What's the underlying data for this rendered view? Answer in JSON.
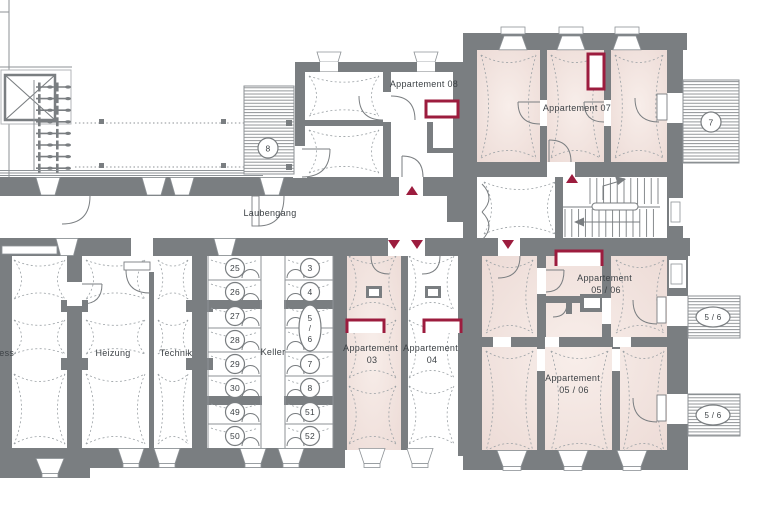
{
  "floorplan": {
    "corridor": {
      "label": "Laubengang"
    },
    "rooms": {
      "fitness": {
        "label": "ness"
      },
      "heizung": {
        "label": "Heizung"
      },
      "technik": {
        "label": "Technik"
      },
      "keller": {
        "label": "Keller"
      },
      "apartment_03": {
        "line1": "Appartement",
        "line2": "03"
      },
      "apartment_04": {
        "line1": "Appartement",
        "line2": "04"
      },
      "apartment_05_06_upper": {
        "line1": "Appartement",
        "line2": "05 / 06"
      },
      "apartment_05_06_lower": {
        "line1": "Appartement",
        "line2": "05 / 06"
      },
      "apartment_07": {
        "label": "Appartement 07"
      },
      "apartment_08": {
        "label": "Appartement 08"
      }
    },
    "terraces": {
      "t7": {
        "label": "7"
      },
      "t8": {
        "label": "8"
      },
      "t56_upper": {
        "label": "5 / 6"
      },
      "t56_lower": {
        "label": "5 / 6"
      }
    },
    "keller_units": {
      "left": [
        "25",
        "26",
        "27",
        "28",
        "29",
        "30",
        "49",
        "50"
      ],
      "right": [
        "3",
        "4",
        "7",
        "8",
        "51",
        "52"
      ],
      "oval": {
        "top": "5",
        "mid": "/",
        "bottom": "6"
      }
    },
    "colors": {
      "wall": "#7a7e81",
      "apartment_fill": "#f2e3df",
      "accent": "#9c1c3e",
      "line": "#8d9296",
      "text": "#3d4246"
    }
  }
}
